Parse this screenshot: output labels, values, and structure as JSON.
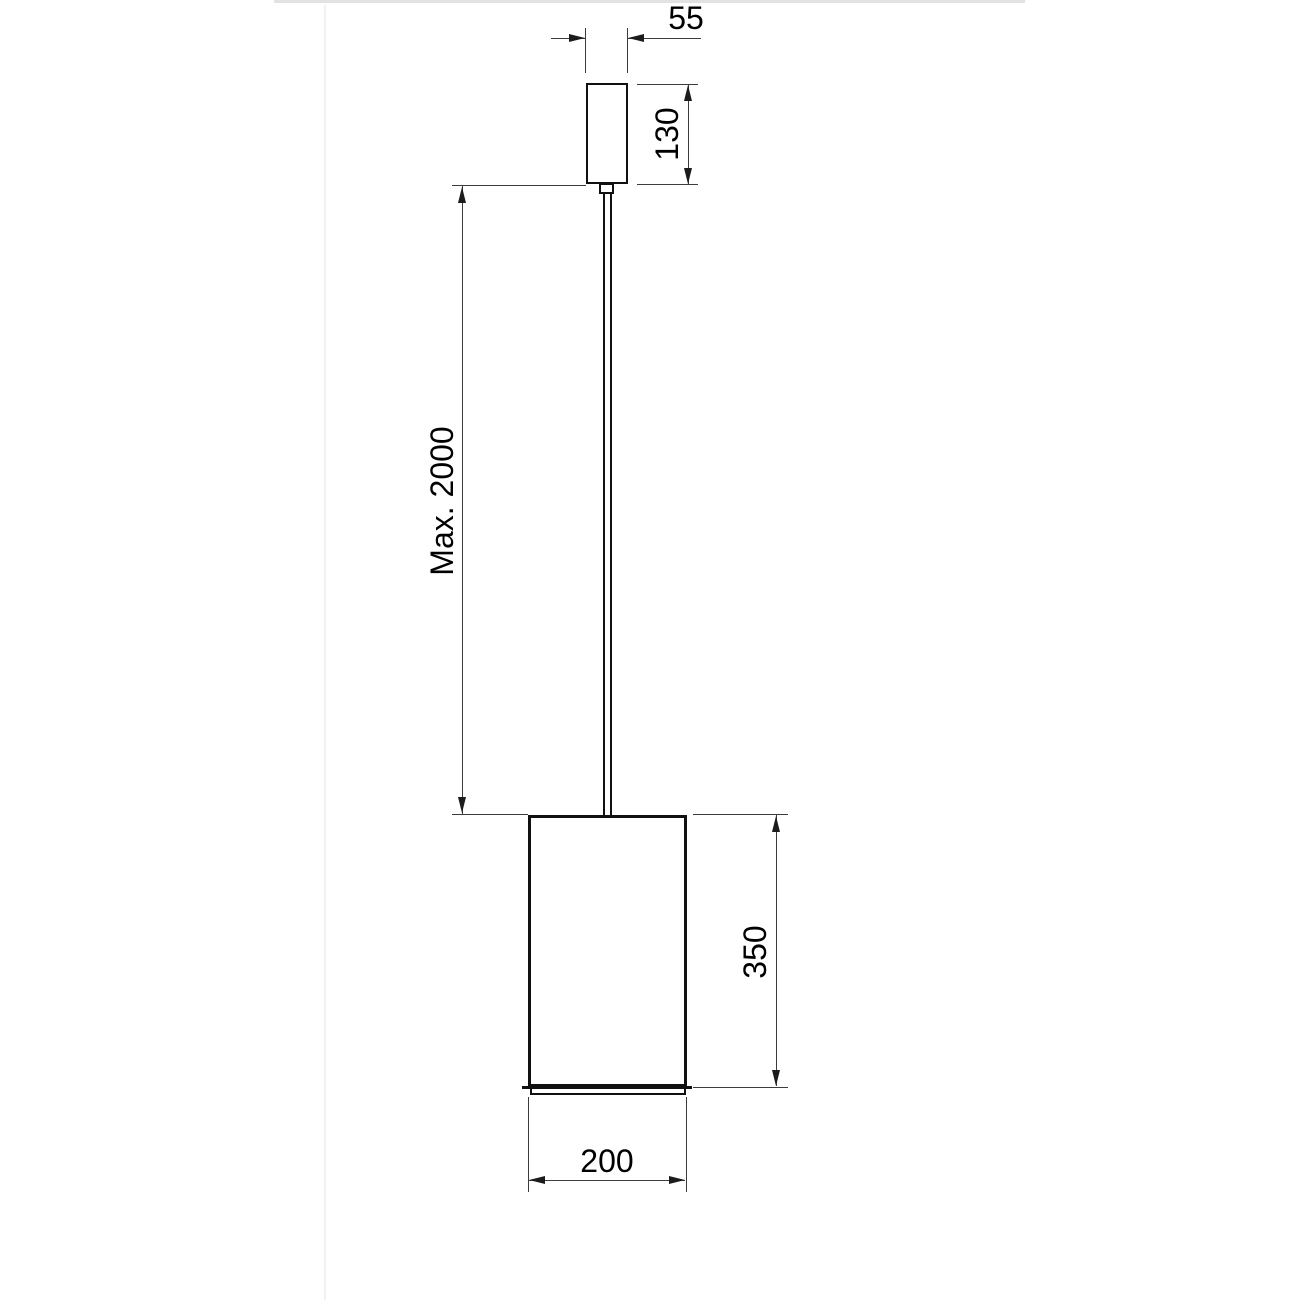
{
  "drawing": {
    "type": "technical-dimension-drawing",
    "subject": "cylindrical pendant lamp",
    "object_line_color": "#111111",
    "dimension_line_color": "#3c3c3c",
    "text_color": "#000000",
    "background_color": "#ffffff",
    "dims": {
      "canopy_width": {
        "label": "55"
      },
      "canopy_height": {
        "label": "130"
      },
      "cable_length": {
        "label": "Max. 2000"
      },
      "shade_height": {
        "label": "350"
      },
      "shade_diameter": {
        "label": "200"
      }
    }
  }
}
